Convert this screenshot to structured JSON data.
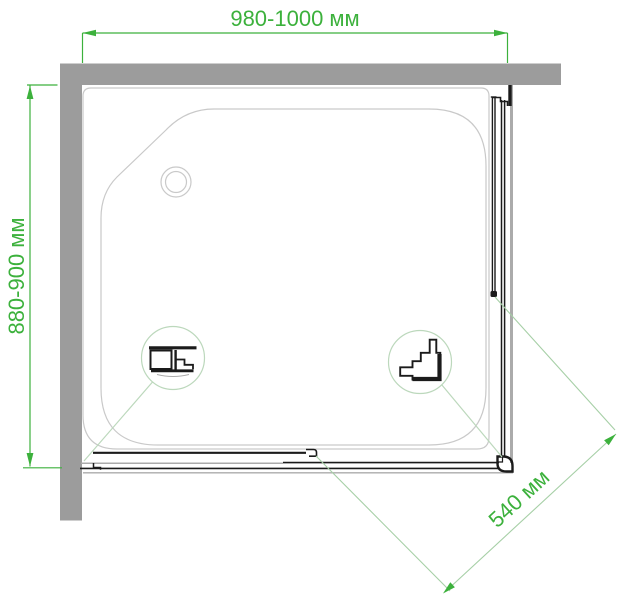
{
  "diagram": {
    "type": "shower-enclosure-top-view-dimension-drawing",
    "labels": {
      "width": "980-1000 мм",
      "depth": "880-900 мм",
      "entry": "540 мм"
    },
    "colors": {
      "dimension": "#3cb13c",
      "dimension_light": "#a6cfa6",
      "detail": "#bcd8bc",
      "wall": "#9c9c9c",
      "tray": "#c9c9c9",
      "rail_gray": "#ababab",
      "profile": "#1b1b1b",
      "background": "#ffffff"
    },
    "icons": {
      "drain": "drain-icon",
      "left_detail": "door-rail-profile-icon",
      "right_detail": "corner-roller-profile-icon"
    }
  }
}
